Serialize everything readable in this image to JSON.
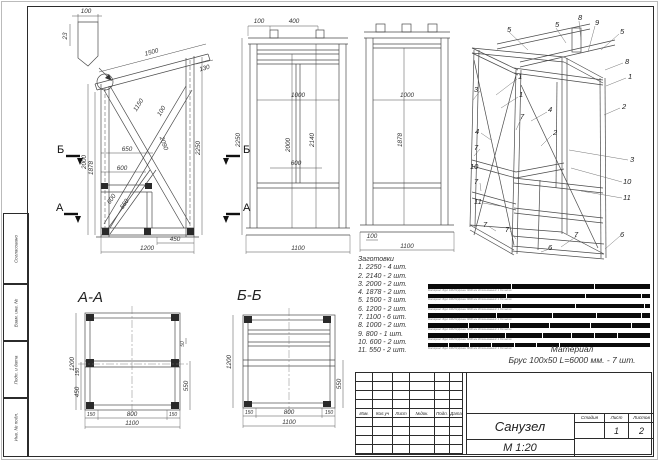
{
  "margin": {
    "labels": [
      "Согласовано",
      "Взам. инв. №",
      "Подп. и дата",
      "Инв. № подл."
    ]
  },
  "side": {
    "dims": [
      "100",
      "23",
      "1500",
      "130",
      "2000",
      "1878",
      "2250",
      "650",
      "600",
      "1150",
      "100",
      "2090",
      "600",
      "550",
      "450",
      "1200"
    ],
    "markers": {
      "b": "Б",
      "a": "А"
    }
  },
  "front1": {
    "dims": [
      "100",
      "400",
      "2250",
      "1000",
      "2000",
      "2140",
      "600",
      "1100"
    ]
  },
  "front2": {
    "dims": [
      "1000",
      "1878",
      "100",
      "1100"
    ]
  },
  "iso": {
    "callouts": [
      "5",
      "5",
      "8",
      "9",
      "5",
      "8",
      "1",
      "2",
      "3",
      "1",
      "1",
      "4",
      "7",
      "2",
      "4",
      "3",
      "7",
      "10",
      "10",
      "7",
      "11",
      "11",
      "7",
      "7",
      "7",
      "6",
      "6"
    ]
  },
  "sectionA": {
    "title": "А-А",
    "dims": [
      "1200",
      "150",
      "450",
      "50",
      "550",
      "150",
      "800",
      "150",
      "1100"
    ]
  },
  "sectionB": {
    "title": "Б-Б",
    "dims": [
      "1200",
      "550",
      "150",
      "800",
      "150",
      "1100"
    ]
  },
  "blanks": {
    "title": "Заготовки",
    "items": [
      "1. 2250 - 4 шт.",
      "2. 2140 - 2 шт.",
      "3. 2000 - 2 шт.",
      "4. 1878 - 2 шт.",
      "5. 1500 - 3 шт.",
      "6. 1200 - 2 шт.",
      "7. 1100 - 6 шт.",
      "8. 1000 - 2 шт.",
      "9. 800 - 1 шт.",
      "10. 600 - 2 шт.",
      "11. 550 - 2 шт."
    ]
  },
  "cutting": {
    "bars": [
      [
        37.5,
        37.5,
        25
      ],
      [
        35.7,
        35.6,
        25,
        3.7
      ],
      [
        33.3,
        33.4,
        31.2,
        2.1
      ],
      [
        31.3,
        25,
        20,
        20,
        3.7
      ],
      [
        18.3,
        18.4,
        18.3,
        18.3,
        18.4,
        8.3
      ],
      [
        18.3,
        16.7,
        16.7,
        13.3,
        10,
        10,
        15
      ],
      [
        9.2,
        9.1,
        10,
        10,
        10,
        10,
        41.7
      ]
    ],
    "bar_caption": "Материал: Брус 100х50   Длина: 6000 мм   Использований: 1   Остаток",
    "material_label": "Материал",
    "material_value": "Брус 100х50 L=6000 мм. - 7 шт."
  },
  "titleblock": {
    "rev_cols": [
      "Изм.",
      "Кол.уч",
      "Лист",
      "№док.",
      "Подп.",
      "Дата"
    ],
    "doc_title": "Санузел",
    "scale": "М 1:20",
    "stage_label": "Стадия",
    "sheet_label": "Лист",
    "sheets_label": "Листов",
    "stage": "",
    "sheet": "1",
    "sheets": "2"
  },
  "colors": {
    "line": "#4a4a4a",
    "bar": "#0a0a0a"
  }
}
